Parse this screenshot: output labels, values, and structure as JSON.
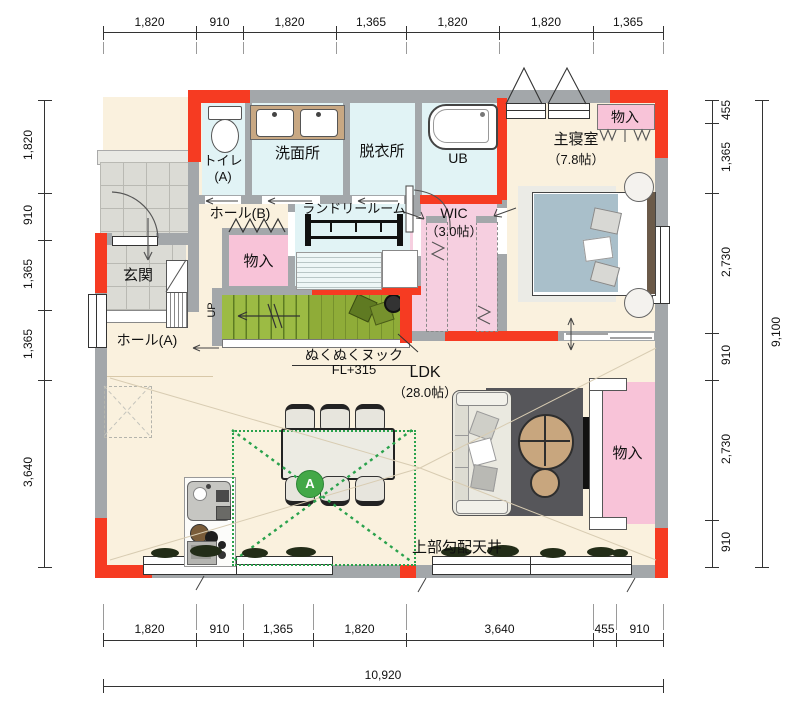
{
  "dimensions": {
    "top": [
      "1,820",
      "910",
      "1,820",
      "1,365",
      "1,820",
      "1,820",
      "1,365"
    ],
    "left": [
      "1,820",
      "910",
      "1,365",
      "1,365",
      "3,640"
    ],
    "right": [
      "455",
      "1,365",
      "2,730",
      "910",
      "2,730",
      "910"
    ],
    "right_total": "9,100",
    "bottom": [
      "1,820",
      "910",
      "1,365",
      "1,820",
      "3,640",
      "455",
      "910"
    ],
    "bottom_total": "10,920"
  },
  "rooms": {
    "toilet_name": "トイレ",
    "toilet_suffix": "(A)",
    "washroom": "洗面所",
    "dressing_room": "脱衣所",
    "unit_bath": "UB",
    "master_bedroom": "主寝室",
    "master_bedroom_size": "（7.8帖）",
    "storage": "物入",
    "hall_b": "ホール(B)",
    "laundry_room": "ランドリールーム",
    "wic": "WIC",
    "wic_size": "（3.0帖）",
    "entrance": "玄関",
    "hall_a": "ホール(A)",
    "ldk": "LDK",
    "ldk_size": "（28.0帖）"
  },
  "annotations": {
    "stairs_up": "UP",
    "nook_name": "ぬくぬくヌック",
    "nook_level": "FL+315",
    "ceiling_note": "上部勾配天井",
    "zone_marker": "A"
  },
  "colors": {
    "wall": "#a3a7aa",
    "accent_red": "#f63b22",
    "floor_cream": "#faf1de",
    "floor_cyan": "#e1f3f5",
    "floor_pink": "#f8c3d8",
    "stairs_green": "#9cbb44",
    "zone_green": "#2aa24c"
  }
}
